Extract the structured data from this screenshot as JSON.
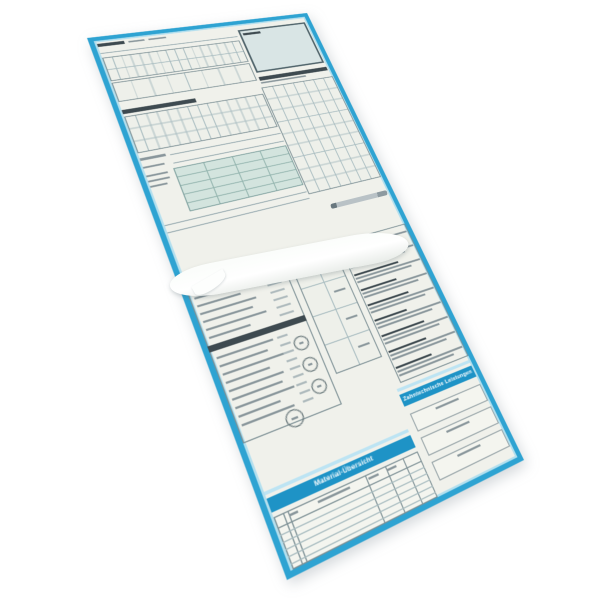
{
  "description": "Tilted product photo of a folded German dental multi-part form set with cyan printed frame",
  "labels": {
    "material": "Material-Übersicht",
    "lab": "Zahntechnische Leistungen"
  },
  "colors": {
    "frame": "#2EA3D2",
    "frameHi": "#A8DCEF",
    "banner": "#1E93C6",
    "bannerHi": "#BDE4F3",
    "paper": "#F0F1EB",
    "paperLight": "#F4F5EF",
    "addr": "#D9E5E5",
    "addrBorder": "#50646B",
    "teal": "#D3E4DE",
    "tealLine": "#93B4AE",
    "tealBorder": "#7FA19F",
    "gridLine": "#A8BCC0",
    "gridBg": "#EEF0EA",
    "tableBorder": "#7E9196",
    "fieldBorder": "#97A4A8",
    "dark": "#3E4A50",
    "grey": "#8A979C",
    "lightGrey": "#AEBABD",
    "line": "#93A7AD",
    "circleBorder": "#5E6E72",
    "background": "#FFFFFF"
  },
  "shapes": [
    {
      "t": "bar",
      "x": 2,
      "y": 4,
      "w": 26,
      "h": 4,
      "c": "dark",
      "n": "form-title-bar"
    },
    {
      "t": "bar",
      "x": 32,
      "y": 5,
      "w": 16,
      "h": 2,
      "c": "grey",
      "n": "form-subtitle-bar"
    },
    {
      "t": "bar",
      "x": 52,
      "y": 5,
      "w": 18,
      "h": 2,
      "c": "grey",
      "n": "form-subtitle-bar"
    },
    {
      "t": "bar",
      "x": 2,
      "y": 16,
      "w": 142,
      "h": 1,
      "c": "line",
      "n": "rule-line"
    },
    {
      "t": "grid",
      "x": 2,
      "y": 22,
      "w": 142,
      "h": 30,
      "cols": 16,
      "rows": 2,
      "n": "chart-grid-upper"
    },
    {
      "t": "grid",
      "x": 2,
      "y": 54,
      "w": 142,
      "h": 24,
      "cols": 8,
      "rows": 1,
      "n": "chart-grid-lower"
    },
    {
      "t": "bar",
      "x": 2,
      "y": 88,
      "w": 72,
      "h": 5,
      "c": "dark",
      "n": "section-heading-bar"
    },
    {
      "t": "grid",
      "x": 2,
      "y": 96,
      "w": 142,
      "h": 44,
      "cols": 14,
      "rows": 3,
      "n": "treatment-grid"
    },
    {
      "t": "bar",
      "x": 2,
      "y": 146,
      "w": 24,
      "h": 3,
      "c": "grey",
      "n": "field-label-bar"
    },
    {
      "t": "bar",
      "x": 30,
      "y": 148,
      "w": 114,
      "h": 1,
      "c": "line",
      "n": "write-in-line"
    },
    {
      "t": "bar",
      "x": 2,
      "y": 156,
      "w": 20,
      "h": 2,
      "c": "grey",
      "n": "field-label-bar"
    },
    {
      "t": "bar",
      "x": 30,
      "y": 158,
      "w": 114,
      "h": 1,
      "c": "line",
      "n": "write-in-line"
    },
    {
      "t": "grid",
      "x": 28,
      "y": 164,
      "w": 116,
      "h": 50,
      "cols": 4,
      "rows": 5,
      "bg": "teal",
      "line": "tealLine",
      "border": "tealBorder",
      "n": "summary-table"
    },
    {
      "t": "rows",
      "x": 2,
      "y": 166,
      "gap": 6,
      "h": 2,
      "c": "grey",
      "widths": [
        20,
        20,
        16
      ],
      "n": "side-label-bars"
    },
    {
      "t": "bar",
      "x": 2,
      "y": 222,
      "w": 142,
      "h": 1,
      "c": "line",
      "n": "rule-line"
    },
    {
      "t": "bar",
      "x": 2,
      "y": 230,
      "w": 142,
      "h": 1,
      "c": "line",
      "n": "rule-line"
    },
    {
      "t": "box",
      "x": 147,
      "y": 8,
      "w": 80,
      "h": 60,
      "bg": "addr",
      "border": "addrBorder",
      "bw": 2,
      "n": "insurer-address-box"
    },
    {
      "t": "bar",
      "x": 151,
      "y": 13,
      "w": 20,
      "h": 3,
      "c": "dark",
      "n": "insurer-box-label"
    },
    {
      "t": "bar",
      "x": 147,
      "y": 74,
      "w": 80,
      "h": 5,
      "c": "dark",
      "n": "right-heading-bar"
    },
    {
      "t": "bar",
      "x": 147,
      "y": 81,
      "w": 52,
      "h": 2,
      "c": "grey",
      "n": "right-subheading-bar"
    },
    {
      "t": "grid",
      "x": 145,
      "y": 88,
      "w": 84,
      "h": 138,
      "cols": 7,
      "rows": 9,
      "n": "fees-grid"
    },
    {
      "t": "box",
      "x": 0,
      "y": 288,
      "w": 92,
      "h": 152,
      "border": "tableBorder",
      "n": "codes-panel"
    },
    {
      "t": "bar",
      "x": 4,
      "y": 292,
      "w": 56,
      "h": 3,
      "c": "dark",
      "n": "codes-heading-bar"
    },
    {
      "t": "rows",
      "x": 4,
      "y": 300,
      "gap": 8,
      "h": 2,
      "c": "grey",
      "widths": [
        56,
        40,
        52,
        46,
        56,
        38
      ],
      "n": "codes-text-lines"
    },
    {
      "t": "rows",
      "x": 70,
      "y": 300,
      "gap": 8,
      "h": 2,
      "c": "lightGrey",
      "widths": [
        14,
        14,
        14,
        14,
        14,
        14
      ],
      "n": "codes-value-lines"
    },
    {
      "t": "bar",
      "x": 0,
      "y": 348,
      "w": 92,
      "h": 6,
      "c": "dark",
      "n": "codes-subheading-strip"
    },
    {
      "t": "rows",
      "x": 4,
      "y": 360,
      "gap": 8,
      "h": 2,
      "c": "grey",
      "widths": [
        52,
        44,
        56,
        40,
        50,
        46,
        54,
        38,
        48
      ],
      "n": "notes-text-lines"
    },
    {
      "t": "rows",
      "x": 60,
      "y": 360,
      "gap": 8,
      "h": 2,
      "c": "lightGrey",
      "widths": [
        10,
        10,
        10,
        10,
        10,
        10,
        10,
        10,
        10
      ],
      "n": "notes-value-lines"
    },
    {
      "t": "circle",
      "x": 72,
      "y": 366,
      "d": 14,
      "n": "icon-circle-1"
    },
    {
      "t": "circle",
      "x": 72,
      "y": 388,
      "d": 14,
      "n": "icon-circle-2"
    },
    {
      "t": "circle",
      "x": 72,
      "y": 410,
      "d": 14,
      "n": "icon-circle-3"
    },
    {
      "t": "circle",
      "x": 40,
      "y": 428,
      "d": 16,
      "n": "seal-stamp-circle"
    },
    {
      "t": "grid",
      "x": 98,
      "y": 292,
      "w": 48,
      "h": 120,
      "cols": 2,
      "rows": 4,
      "n": "checkbox-grid"
    },
    {
      "t": "rows",
      "x": 128,
      "y": 304,
      "gap": 30,
      "h": 2,
      "c": "grey",
      "widths": [
        12,
        12,
        12,
        12
      ],
      "n": "checkbox-mark-bars"
    },
    {
      "t": "box",
      "x": 152,
      "y": 286,
      "w": 78,
      "h": 156,
      "border": "tableBorder",
      "n": "instructions-panel"
    },
    {
      "t": "para",
      "x": 154,
      "y": 290,
      "w": 74,
      "lead": 44,
      "n": "instruction-paragraph"
    },
    {
      "t": "para",
      "x": 154,
      "y": 307,
      "w": 74,
      "lead": 38,
      "n": "instruction-paragraph"
    },
    {
      "t": "para",
      "x": 154,
      "y": 324,
      "w": 74,
      "lead": 50,
      "n": "instruction-paragraph"
    },
    {
      "t": "para",
      "x": 154,
      "y": 341,
      "w": 74,
      "lead": 40,
      "n": "instruction-paragraph"
    },
    {
      "t": "para",
      "x": 154,
      "y": 358,
      "w": 74,
      "lead": 46,
      "n": "instruction-paragraph"
    },
    {
      "t": "para",
      "x": 154,
      "y": 375,
      "w": 74,
      "lead": 36,
      "n": "instruction-paragraph"
    },
    {
      "t": "para",
      "x": 154,
      "y": 392,
      "w": 74,
      "lead": 48,
      "n": "instruction-paragraph"
    },
    {
      "t": "para",
      "x": 154,
      "y": 409,
      "w": 74,
      "lead": 42,
      "n": "instruction-paragraph"
    },
    {
      "t": "para",
      "x": 154,
      "y": 426,
      "w": 74,
      "lead": 40,
      "n": "instruction-paragraph"
    },
    {
      "t": "bar",
      "x": 146,
      "y": 446,
      "w": 82,
      "h": 3,
      "c": "bannerHi",
      "n": "lab-banner-highlight"
    },
    {
      "t": "banner",
      "x": 146,
      "y": 452,
      "w": 82,
      "h": 12,
      "k": "lab",
      "fs": 5.5,
      "n": "lab-banner"
    },
    {
      "t": "box",
      "x": 148,
      "y": 472,
      "w": 80,
      "h": 18,
      "bg": "paperLight",
      "border": "fieldBorder",
      "n": "lab-field-box-1"
    },
    {
      "t": "bar",
      "x": 174,
      "y": 476,
      "w": 26,
      "h": 2,
      "c": "grey",
      "n": "lab-field-label"
    },
    {
      "t": "box",
      "x": 148,
      "y": 496,
      "w": 80,
      "h": 18,
      "bg": "paperLight",
      "border": "fieldBorder",
      "n": "lab-field-box-2"
    },
    {
      "t": "bar",
      "x": 174,
      "y": 500,
      "w": 26,
      "h": 2,
      "c": "grey",
      "n": "lab-field-label"
    },
    {
      "t": "box",
      "x": 148,
      "y": 520,
      "w": 80,
      "h": 18,
      "bg": "paperLight",
      "border": "fieldBorder",
      "n": "lab-field-box-3"
    },
    {
      "t": "bar",
      "x": 174,
      "y": 524,
      "w": 26,
      "h": 2,
      "c": "grey",
      "n": "lab-field-label"
    },
    {
      "t": "bar",
      "x": 2,
      "y": 484,
      "w": 138,
      "h": 3,
      "c": "bannerHi",
      "n": "material-banner-highlight"
    },
    {
      "t": "banner",
      "x": 2,
      "y": 490,
      "w": 138,
      "h": 12,
      "k": "material",
      "fs": 6,
      "n": "material-banner"
    },
    {
      "t": "box",
      "x": 2,
      "y": 506,
      "w": 138,
      "h": 44,
      "bg": "paperLight",
      "border": "tableBorder",
      "n": "material-table"
    },
    {
      "t": "lines",
      "dir": "v",
      "x": 2,
      "y": 506,
      "len": 44,
      "at": [
        8,
        12,
        84,
        104,
        122
      ],
      "c": "tableBorder",
      "n": "material-table-column-line"
    },
    {
      "t": "lines",
      "dir": "h",
      "x": 2,
      "y": 506,
      "len": 138,
      "at": [
        9
      ],
      "c": "tableBorder",
      "n": "material-table-header-line"
    },
    {
      "t": "lines",
      "dir": "h",
      "x": 2,
      "y": 506,
      "len": 138,
      "at": [
        15,
        21,
        27,
        33,
        39
      ],
      "c": "gridLine",
      "n": "material-table-row-line"
    },
    {
      "t": "bar",
      "x": 40,
      "y": 509,
      "w": 30,
      "h": 2,
      "c": "grey",
      "n": "material-col-header"
    },
    {
      "t": "bar",
      "x": 88,
      "y": 509,
      "w": 10,
      "h": 2,
      "c": "grey",
      "n": "material-col-header"
    },
    {
      "t": "bar",
      "x": 106,
      "y": 509,
      "w": 10,
      "h": 2,
      "c": "grey",
      "n": "material-col-header"
    },
    {
      "t": "bar",
      "x": 14,
      "y": 509,
      "w": 8,
      "h": 2,
      "c": "grey",
      "n": "material-col-header"
    }
  ]
}
